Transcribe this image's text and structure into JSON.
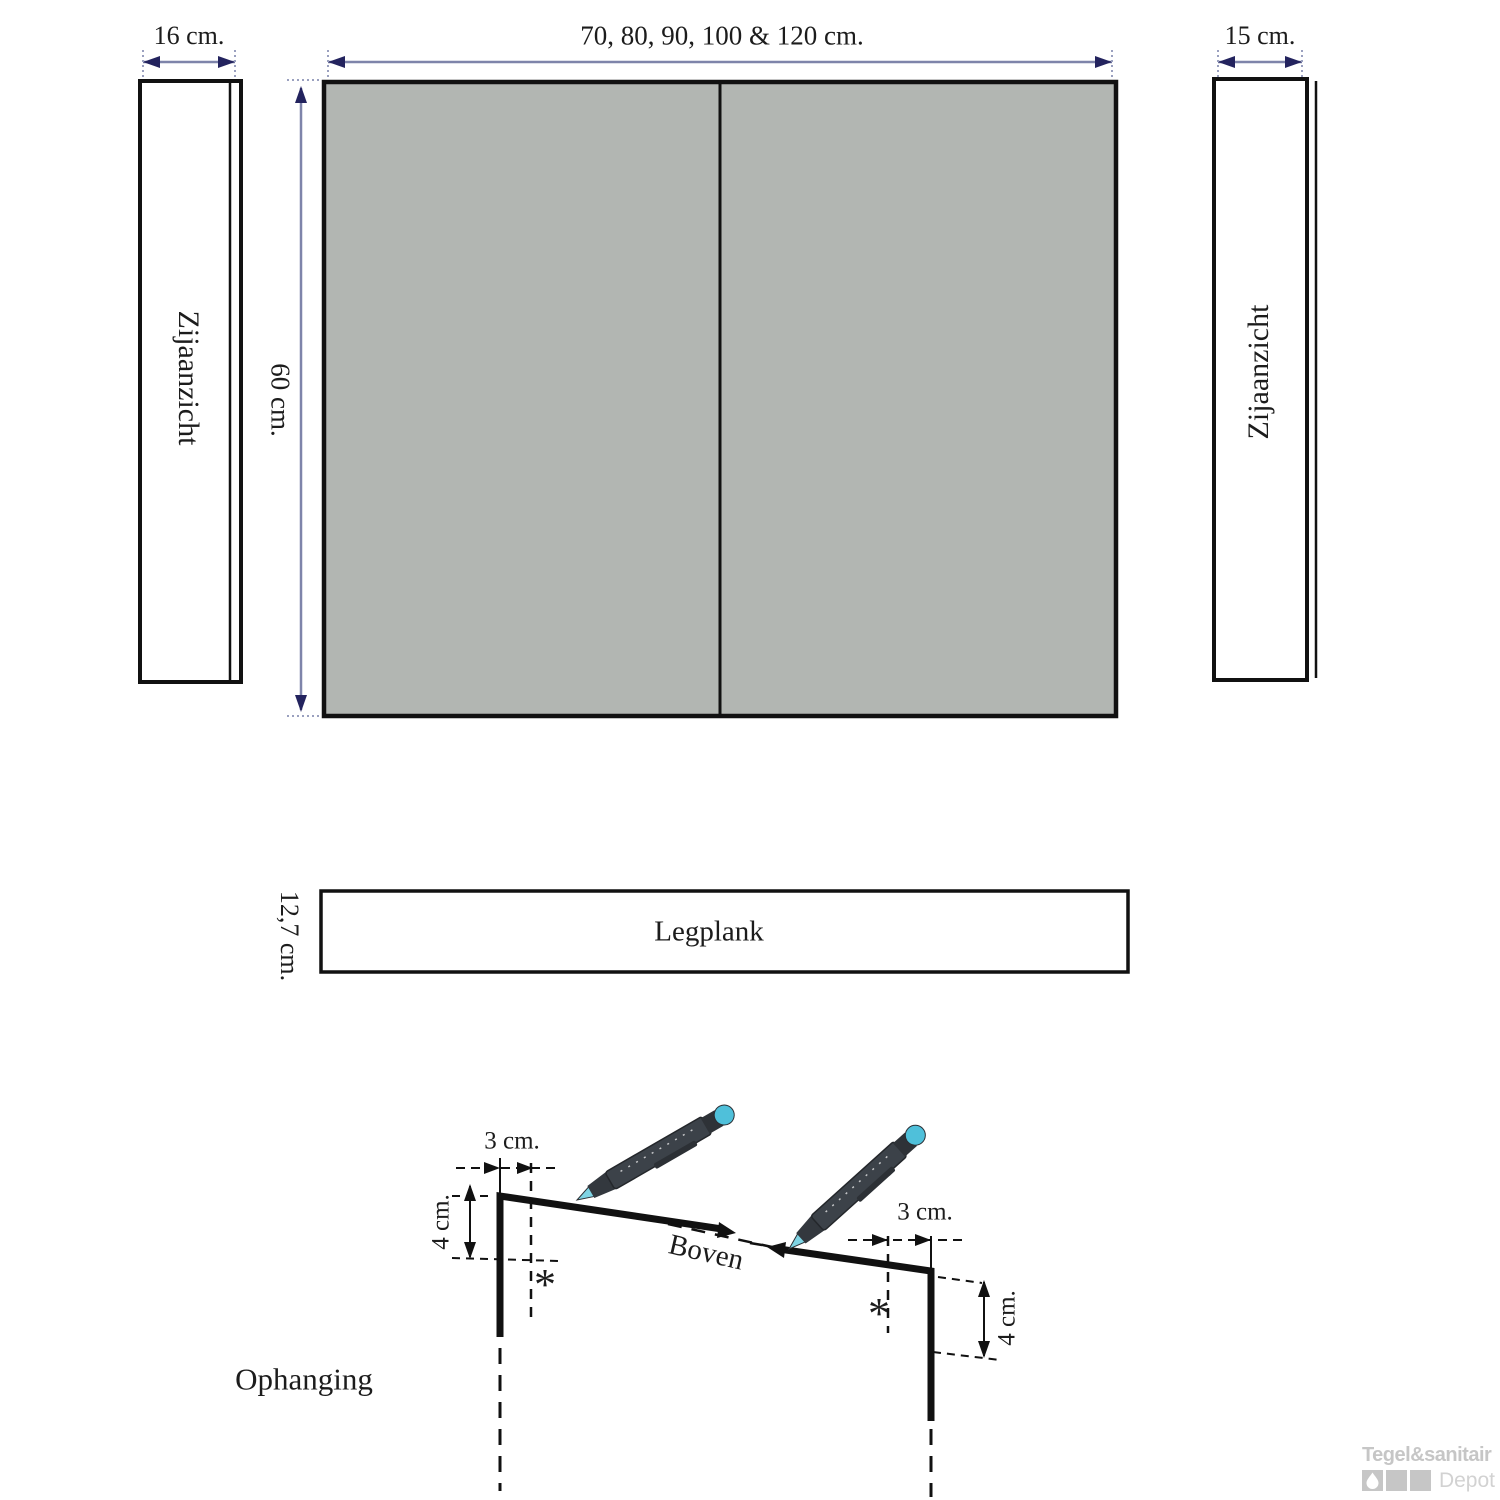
{
  "views": {
    "left_side_view": {
      "dim_width": "16 cm.",
      "label": "Zijaanzicht"
    },
    "front_view": {
      "dim_width": "70, 80, 90, 100 & 120 cm.",
      "dim_height": "60 cm."
    },
    "right_side_view": {
      "dim_width": "15 cm.",
      "label": "Zijaanzicht"
    },
    "shelf": {
      "label": "Legplank",
      "dim_height": "12,7 cm."
    },
    "mounting": {
      "label": "Ophanging",
      "direction_label": "Boven",
      "left_bracket": {
        "dim_offset": "3 cm.",
        "dim_drop": "4 cm.",
        "drill_mark": "*"
      },
      "right_bracket": {
        "dim_offset": "3 cm.",
        "dim_drop": "4 cm.",
        "drill_mark": "*"
      }
    }
  },
  "watermark": {
    "brand": "Tegel&sanitair",
    "product_line": "Depot"
  },
  "colors": {
    "cabinet_fill": "#b2b6b2",
    "drawing_line": "#111111",
    "dim_line": "#7e84aa",
    "dim_arrow": "#23235e",
    "pen_body": "#3c4249",
    "pen_accent": "#4fc0da",
    "watermark_gray": "#c6c6c6"
  }
}
